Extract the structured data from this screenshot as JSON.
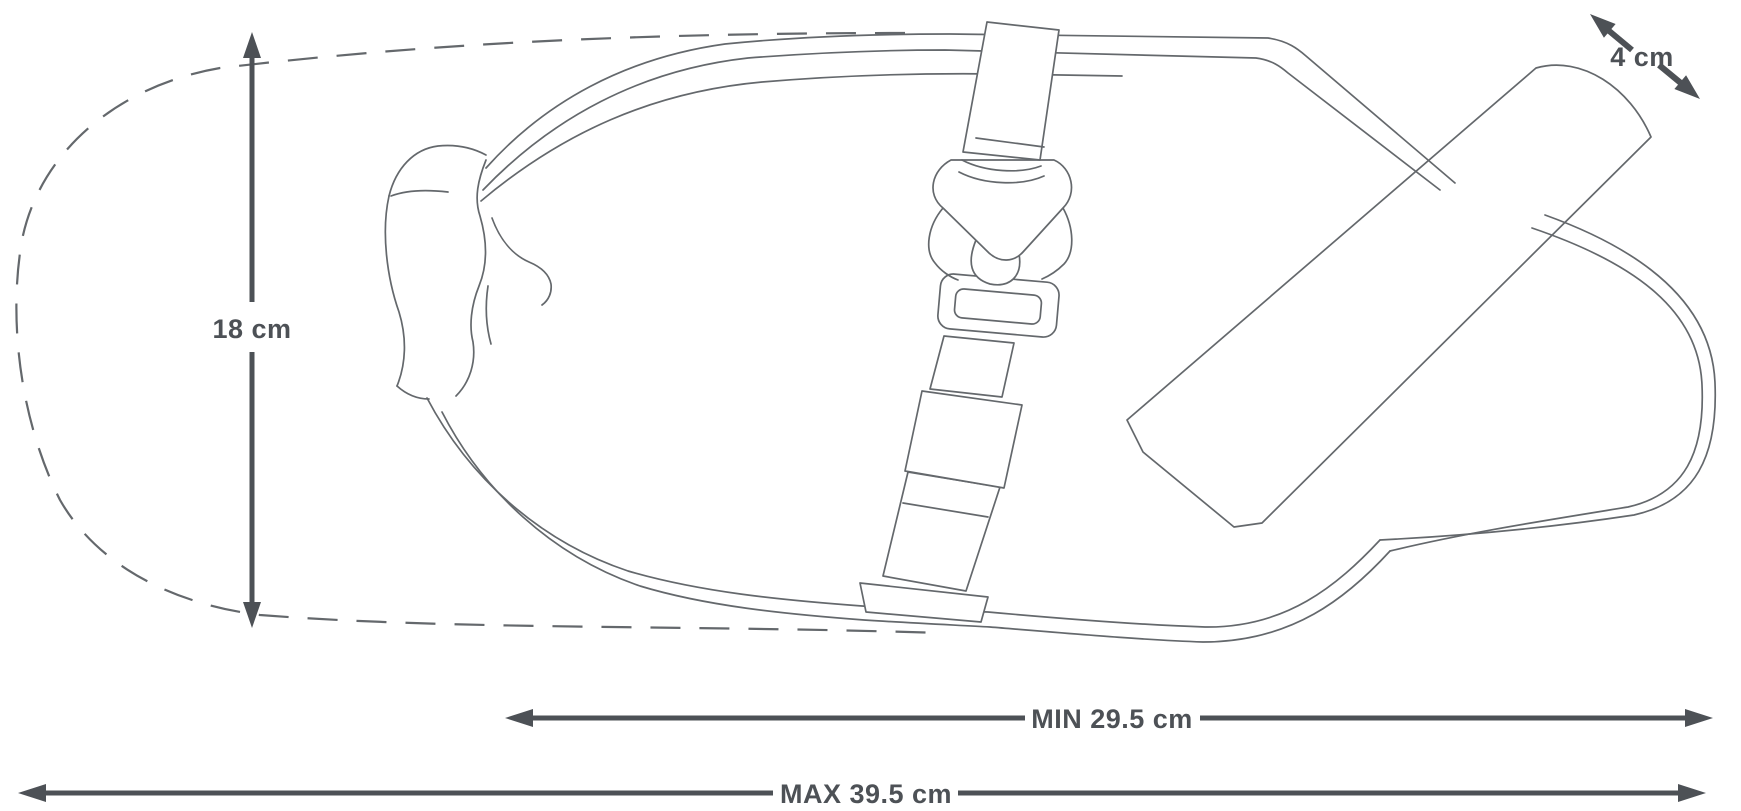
{
  "diagram": {
    "colors": {
      "background": "#ffffff",
      "line": "#64686c",
      "dimension": "#4d5156"
    },
    "dimensions": {
      "height": {
        "label": "18 cm",
        "value": 18,
        "unit": "cm"
      },
      "strap_width": {
        "label": "4 cm",
        "value": 4,
        "unit": "cm"
      },
      "min_length": {
        "label": "MIN 29.5 cm",
        "value": 29.5,
        "unit": "cm"
      },
      "max_length": {
        "label": "MAX 39.5 cm",
        "value": 39.5,
        "unit": "cm"
      }
    }
  }
}
